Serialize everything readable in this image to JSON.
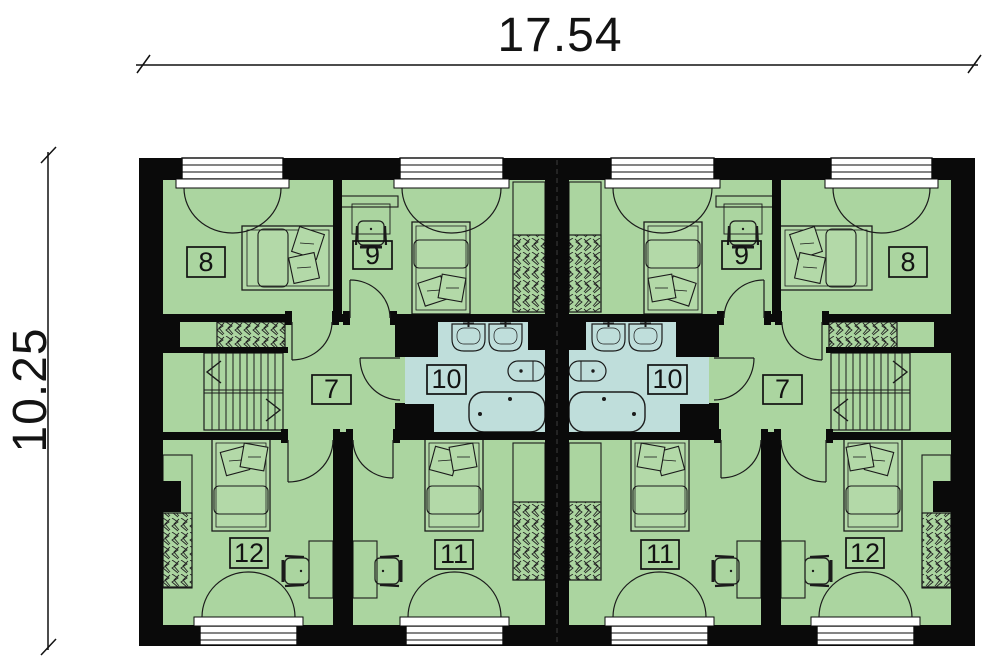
{
  "dimensions": {
    "width_label": "17.54",
    "height_label": "10.25"
  },
  "rooms": [
    {
      "id": "bedroom-top-outer-left",
      "number": "8"
    },
    {
      "id": "bedroom-top-inner-left",
      "number": "9"
    },
    {
      "id": "hall-left",
      "number": "7"
    },
    {
      "id": "bathroom-left",
      "number": "10"
    },
    {
      "id": "bedroom-bottom-inner-left",
      "number": "11"
    },
    {
      "id": "bedroom-bottom-outer-left",
      "number": "12"
    },
    {
      "id": "bathroom-right",
      "number": "10"
    },
    {
      "id": "hall-right",
      "number": "7"
    },
    {
      "id": "bedroom-top-inner-right",
      "number": "9"
    },
    {
      "id": "bedroom-top-outer-right",
      "number": "8"
    },
    {
      "id": "bedroom-bottom-inner-right",
      "number": "11"
    },
    {
      "id": "bedroom-bottom-outer-right",
      "number": "12"
    }
  ],
  "colors": {
    "wall": "#0a0a0a",
    "room_fill": "#abd5a0",
    "bathroom_fill": "#bfdedb",
    "line": "#1b1b1b",
    "background": "#ffffff"
  },
  "icons": {
    "bed": "bed-icon",
    "pillow": "pillow-icon",
    "wardrobe": "wardrobe-hatch-icon",
    "stairs": "stairs-icon",
    "stairs_up_arrow": "stair-direction-arrow",
    "sink": "sink-icon",
    "toilet": "toilet-icon",
    "bathtub": "bathtub-icon",
    "desk": "desk-icon",
    "chair": "chair-icon",
    "door": "door-swing-arc",
    "window": "casement-window-icon"
  }
}
